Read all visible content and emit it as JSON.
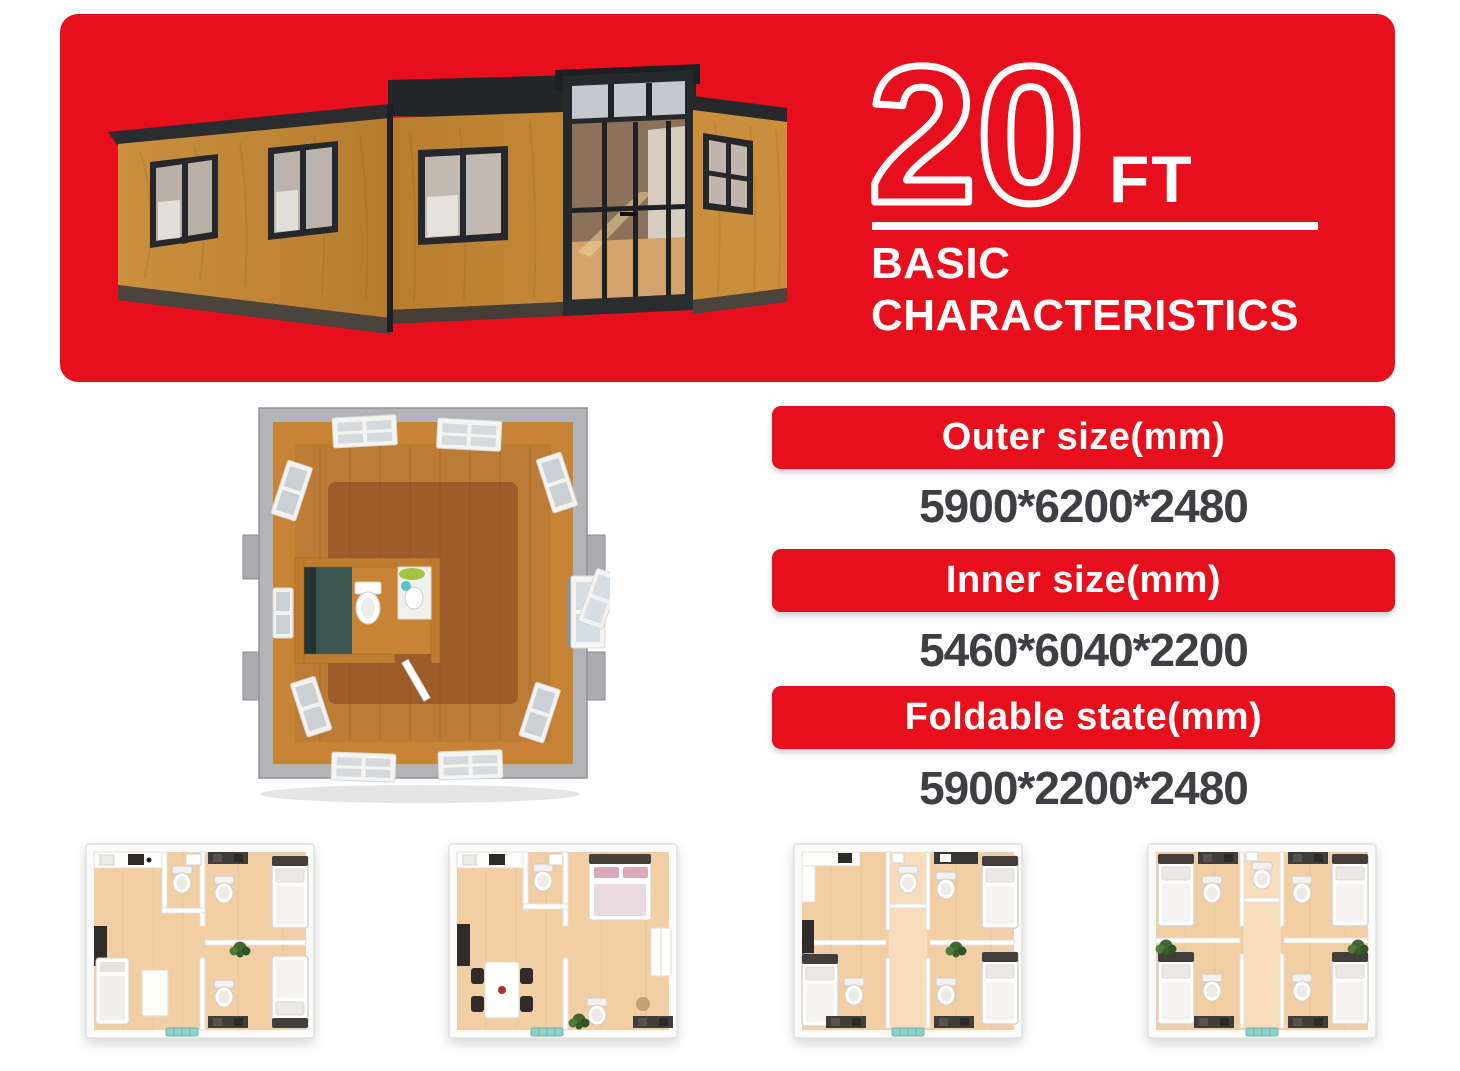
{
  "banner": {
    "size_value": "20",
    "size_unit": "FT",
    "title_line1": "BASIC",
    "title_line2": "CHARACTERISTICS"
  },
  "specs": [
    {
      "label": "Outer size(mm)",
      "value": "5900*6200*2480"
    },
    {
      "label": "Inner size(mm)",
      "value": "5460*6040*2200"
    },
    {
      "label": "Foldable state(mm)",
      "value": "5900*2200*2480"
    }
  ],
  "colors": {
    "accent_red": "#E60F1B",
    "banner_text": "#FFFFFF",
    "value_text": "#3E3E43",
    "wood_panel": "#C88C3B",
    "dark_frame": "#26282C",
    "floor_wood": "#9C5C2B"
  },
  "illustrations": {
    "hero": "expandable-container-house-3d-render",
    "floorplan_top": "expanded-house-top-view-floorplan",
    "thumbnails": [
      "floorplan-two-bedrooms-living-kitchen",
      "floorplan-one-bedroom-dining-kitchen",
      "floorplan-three-bedrooms-kitchen",
      "floorplan-four-bedrooms-central-corridor"
    ]
  }
}
